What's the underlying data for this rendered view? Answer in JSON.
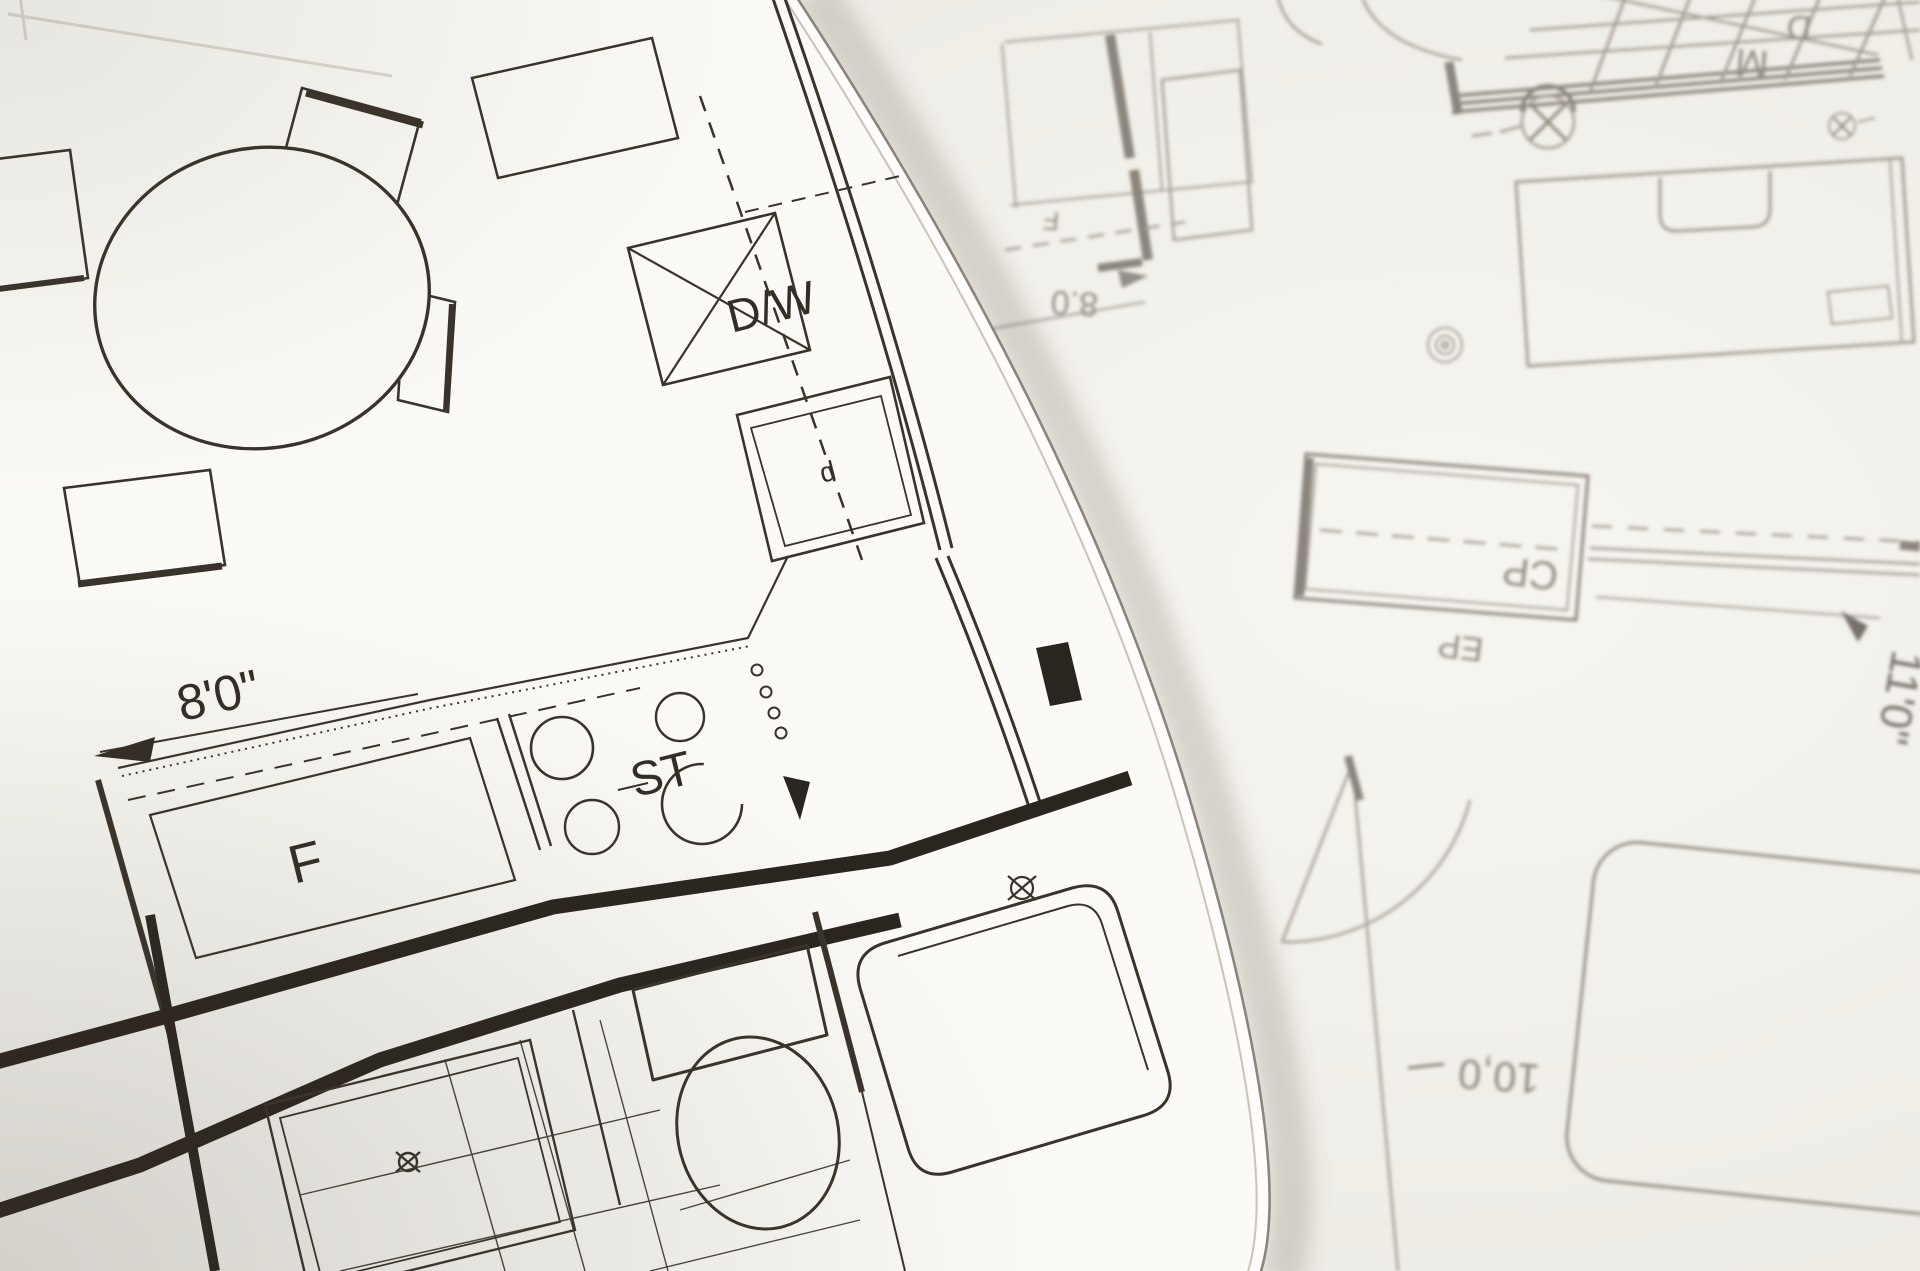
{
  "front_sheet": {
    "labels": {
      "dishwasher": "D/W",
      "sink_letter": "d",
      "stove": "ST",
      "refrigerator": "F",
      "dimension_8ft": "8'0\""
    }
  },
  "back_sheet": {
    "labels": {
      "letter_m": "M",
      "letter_d": "D",
      "room_letter": "F",
      "dimension_8ft_inverted": "8.0",
      "closet": "CP",
      "closet_ep": "EP",
      "dimension_11ft": "11'0\"",
      "dimension_10ft_inverted": "10,0"
    }
  },
  "colors": {
    "front_ink": "#332d26",
    "front_wall_ink": "#2a251f",
    "back_ink": "#a49e94",
    "back_dark_ink": "#8b857b",
    "front_paper": "#fbfaf6",
    "back_paper": "#f2f0ea",
    "edge_line": "#8b847b"
  }
}
